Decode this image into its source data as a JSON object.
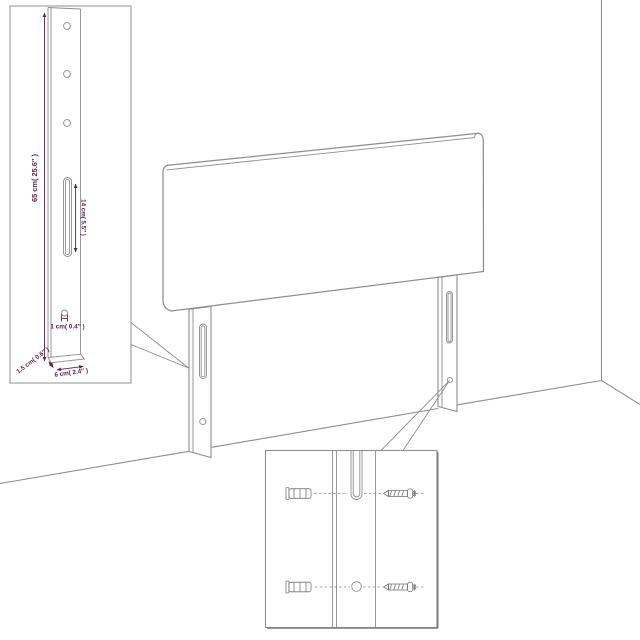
{
  "colors": {
    "background": "#ffffff",
    "line": "#8e8e8e",
    "hardware_line": "#787878",
    "dimension_accent": "#5c2547"
  },
  "diagram": {
    "subject": "headboard-with-mounting-legs-assembly-diagram",
    "dimensions": {
      "leg_height": "65 cm( 25.6″ )",
      "slot_length": "14 cm( 5.5″ )",
      "hole_size": "1 cm( 0.4″ )",
      "leg_depth": "1.5 cm( 0.6″ )",
      "leg_width": "6 cm( 2.4″ )"
    },
    "icons": [
      "wall-plug-icon",
      "screw-icon",
      "mounting-slot",
      "mounting-hole"
    ]
  }
}
